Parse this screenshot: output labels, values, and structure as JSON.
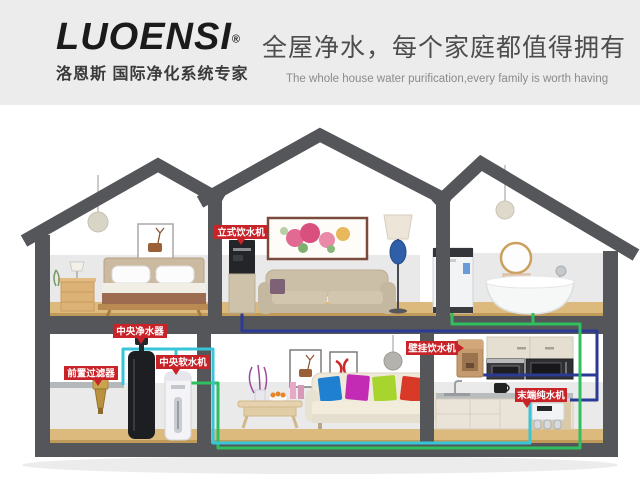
{
  "header": {
    "brand": "LUOENSI",
    "registered": "®",
    "brand_sub": "洛恩斯 国际净化系统专家",
    "slogan": "全屋净水，每个家庭都值得拥有",
    "slogan_en": "The whole house water purification,every family is worth having"
  },
  "labels": {
    "standing_dispenser": "立式饮水机",
    "central_purifier": "中央净水器",
    "pre_filter": "前置过滤器",
    "central_softener": "中央软水机",
    "wall_dispenser": "壁挂饮水机",
    "terminal_ro": "末端纯水机"
  },
  "colors": {
    "label_red": "#c9232a",
    "wall_gray": "#55565a",
    "pipe_cyan": "#38c5d8",
    "pipe_green": "#2fbf5e",
    "pipe_blue": "#2b3a94",
    "floor_wood": "#d8b97c",
    "header_bg": "#ececec"
  }
}
